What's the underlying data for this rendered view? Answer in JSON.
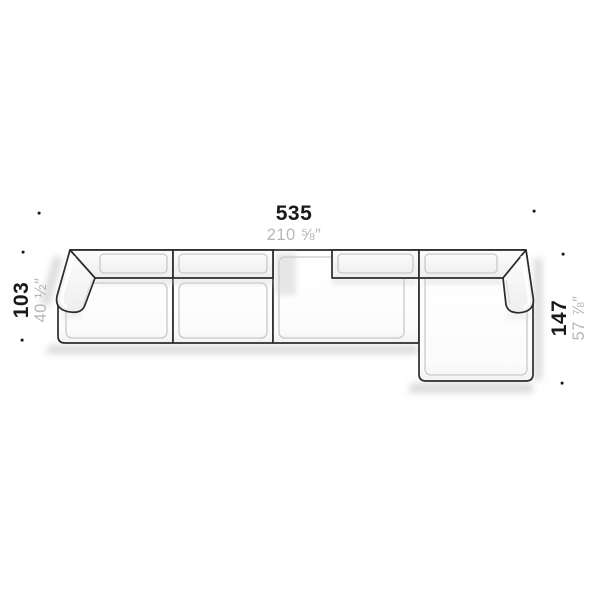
{
  "diagram": {
    "subject": "sectional-sofa-with-chaise-plan-view",
    "dim_top": {
      "cm": "535",
      "in": "210 ⅝″"
    },
    "dim_left": {
      "cm": "103",
      "in": "40 ½″"
    },
    "dim_right": {
      "cm": "147",
      "in": "57 ⅞″"
    },
    "colors": {
      "background": "#ffffff",
      "outline": "#2b2b2b",
      "dim_cm_text": "#1a1a1a",
      "dim_in_text": "#b7b7b7",
      "inset_line": "#c9c9c9",
      "shadow": "#bdbdbd"
    }
  }
}
